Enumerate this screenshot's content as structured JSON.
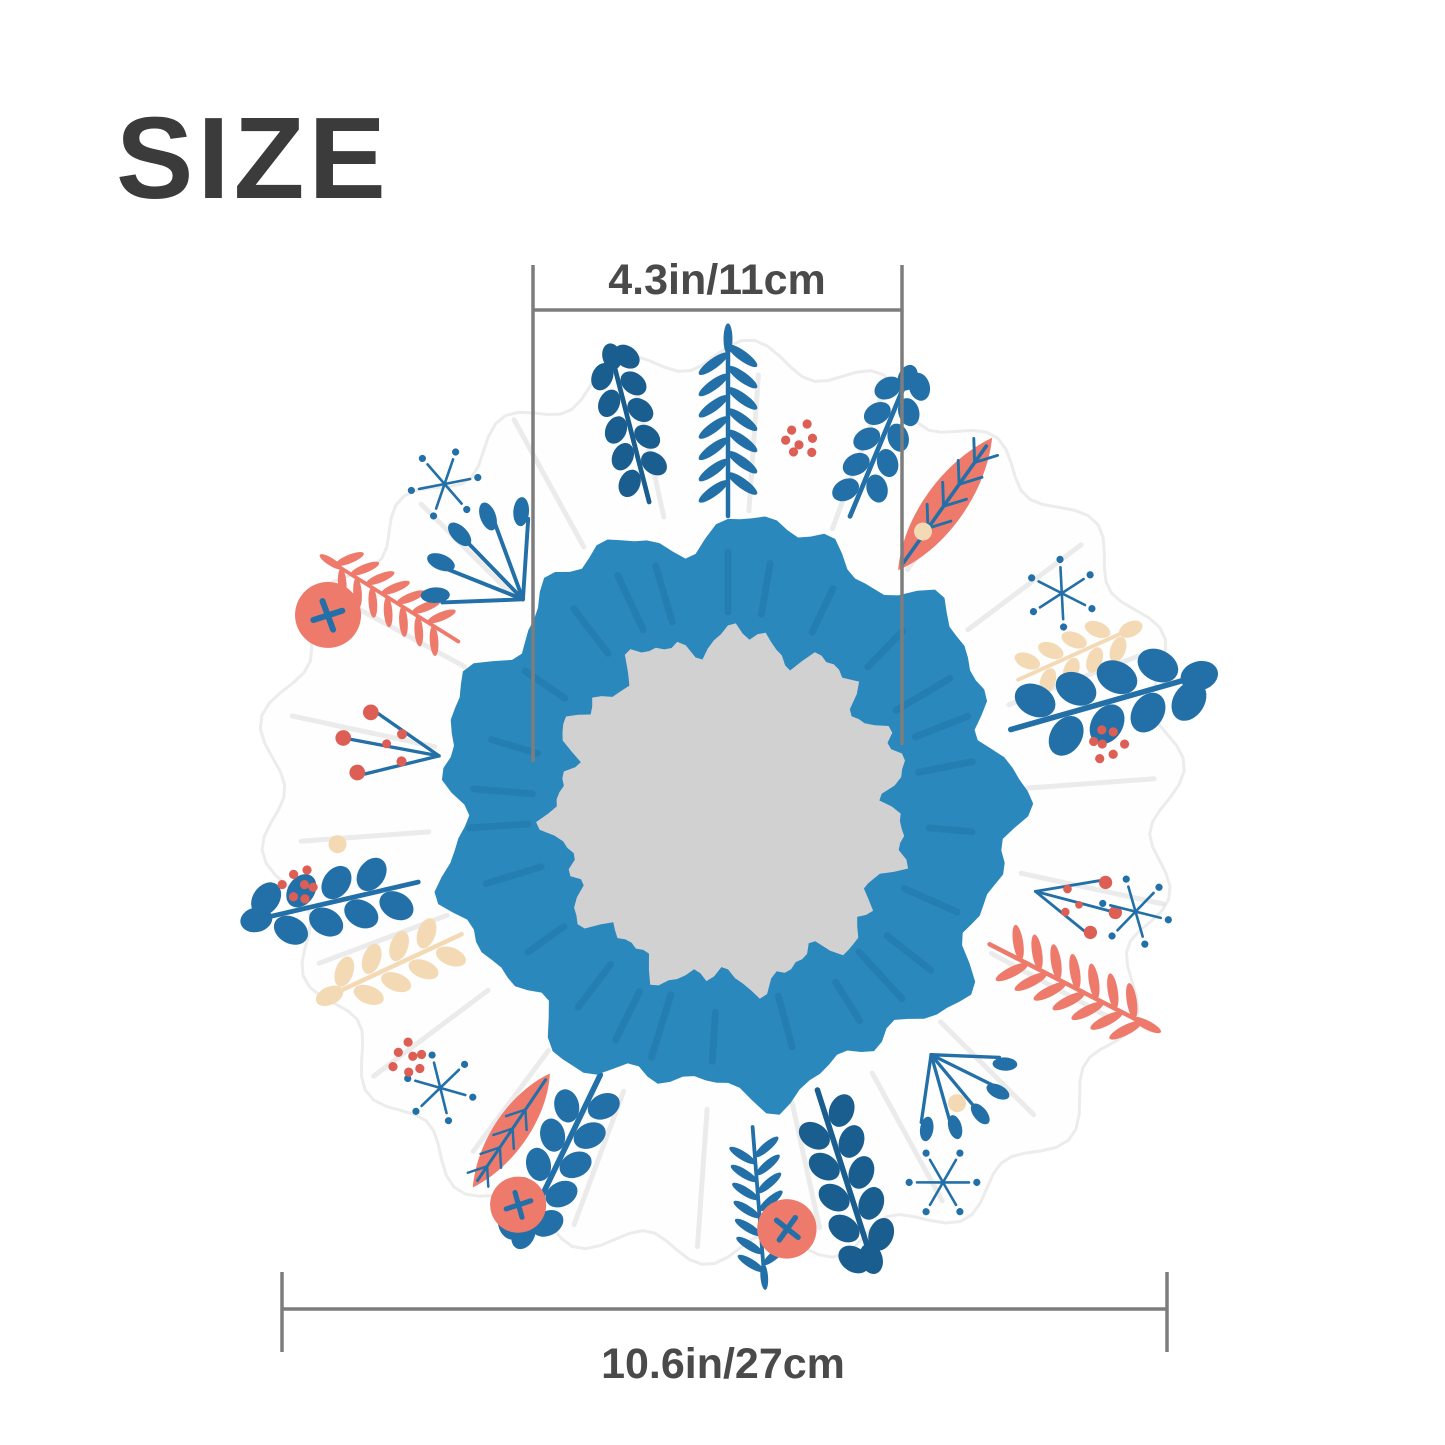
{
  "title": {
    "text": "SIZE",
    "color": "#3b3b3b"
  },
  "measurements": {
    "inner_diameter": {
      "label": "4.3in/11cm"
    },
    "outer_diameter": {
      "label": "10.6in/27cm"
    },
    "line_color": "#7d7d7d",
    "label_color": "#4a4a4a"
  },
  "product": {
    "subject": "round ruffled shower cap, top view, floral print, gray center hole",
    "colors": {
      "fabric": "#fefefe",
      "fabric_edge": "#ececec",
      "crease": "#dcdcdc",
      "band_blue": "#2b88bd",
      "band_blue_dark": "#1d6e9e",
      "center_gray": "#d1d1d1",
      "leaf_blue": "#2270a7",
      "leaf_blue_dark": "#1a5d8f",
      "leaf_coral": "#ee7a6c",
      "leaf_beige": "#f3d9b4",
      "berry_red": "#dd5e55"
    }
  }
}
